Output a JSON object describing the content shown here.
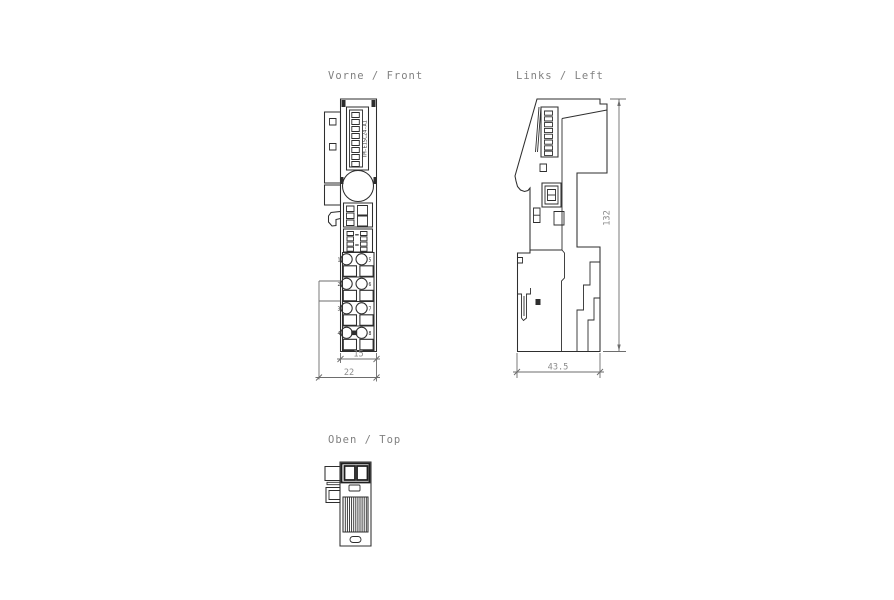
{
  "page": {
    "background": "#ffffff"
  },
  "colors": {
    "line": "#2e2e2e",
    "dimension_text": "#8a8a8a",
    "title_text": "#818181"
  },
  "views": {
    "front": {
      "title": "Vorne / Front",
      "module_label": "TM-E15C24-A1",
      "terminal_numbers": [
        [
          "1",
          "5"
        ],
        [
          "2",
          "6"
        ],
        [
          "3",
          "7"
        ],
        [
          "4",
          "8"
        ]
      ],
      "dimensions": {
        "body_width": "15",
        "overall_width": "22"
      }
    },
    "left": {
      "title": "Links / Left",
      "dimensions": {
        "height": "132",
        "depth": "43.5"
      }
    },
    "top": {
      "title": "Oben / Top"
    }
  }
}
